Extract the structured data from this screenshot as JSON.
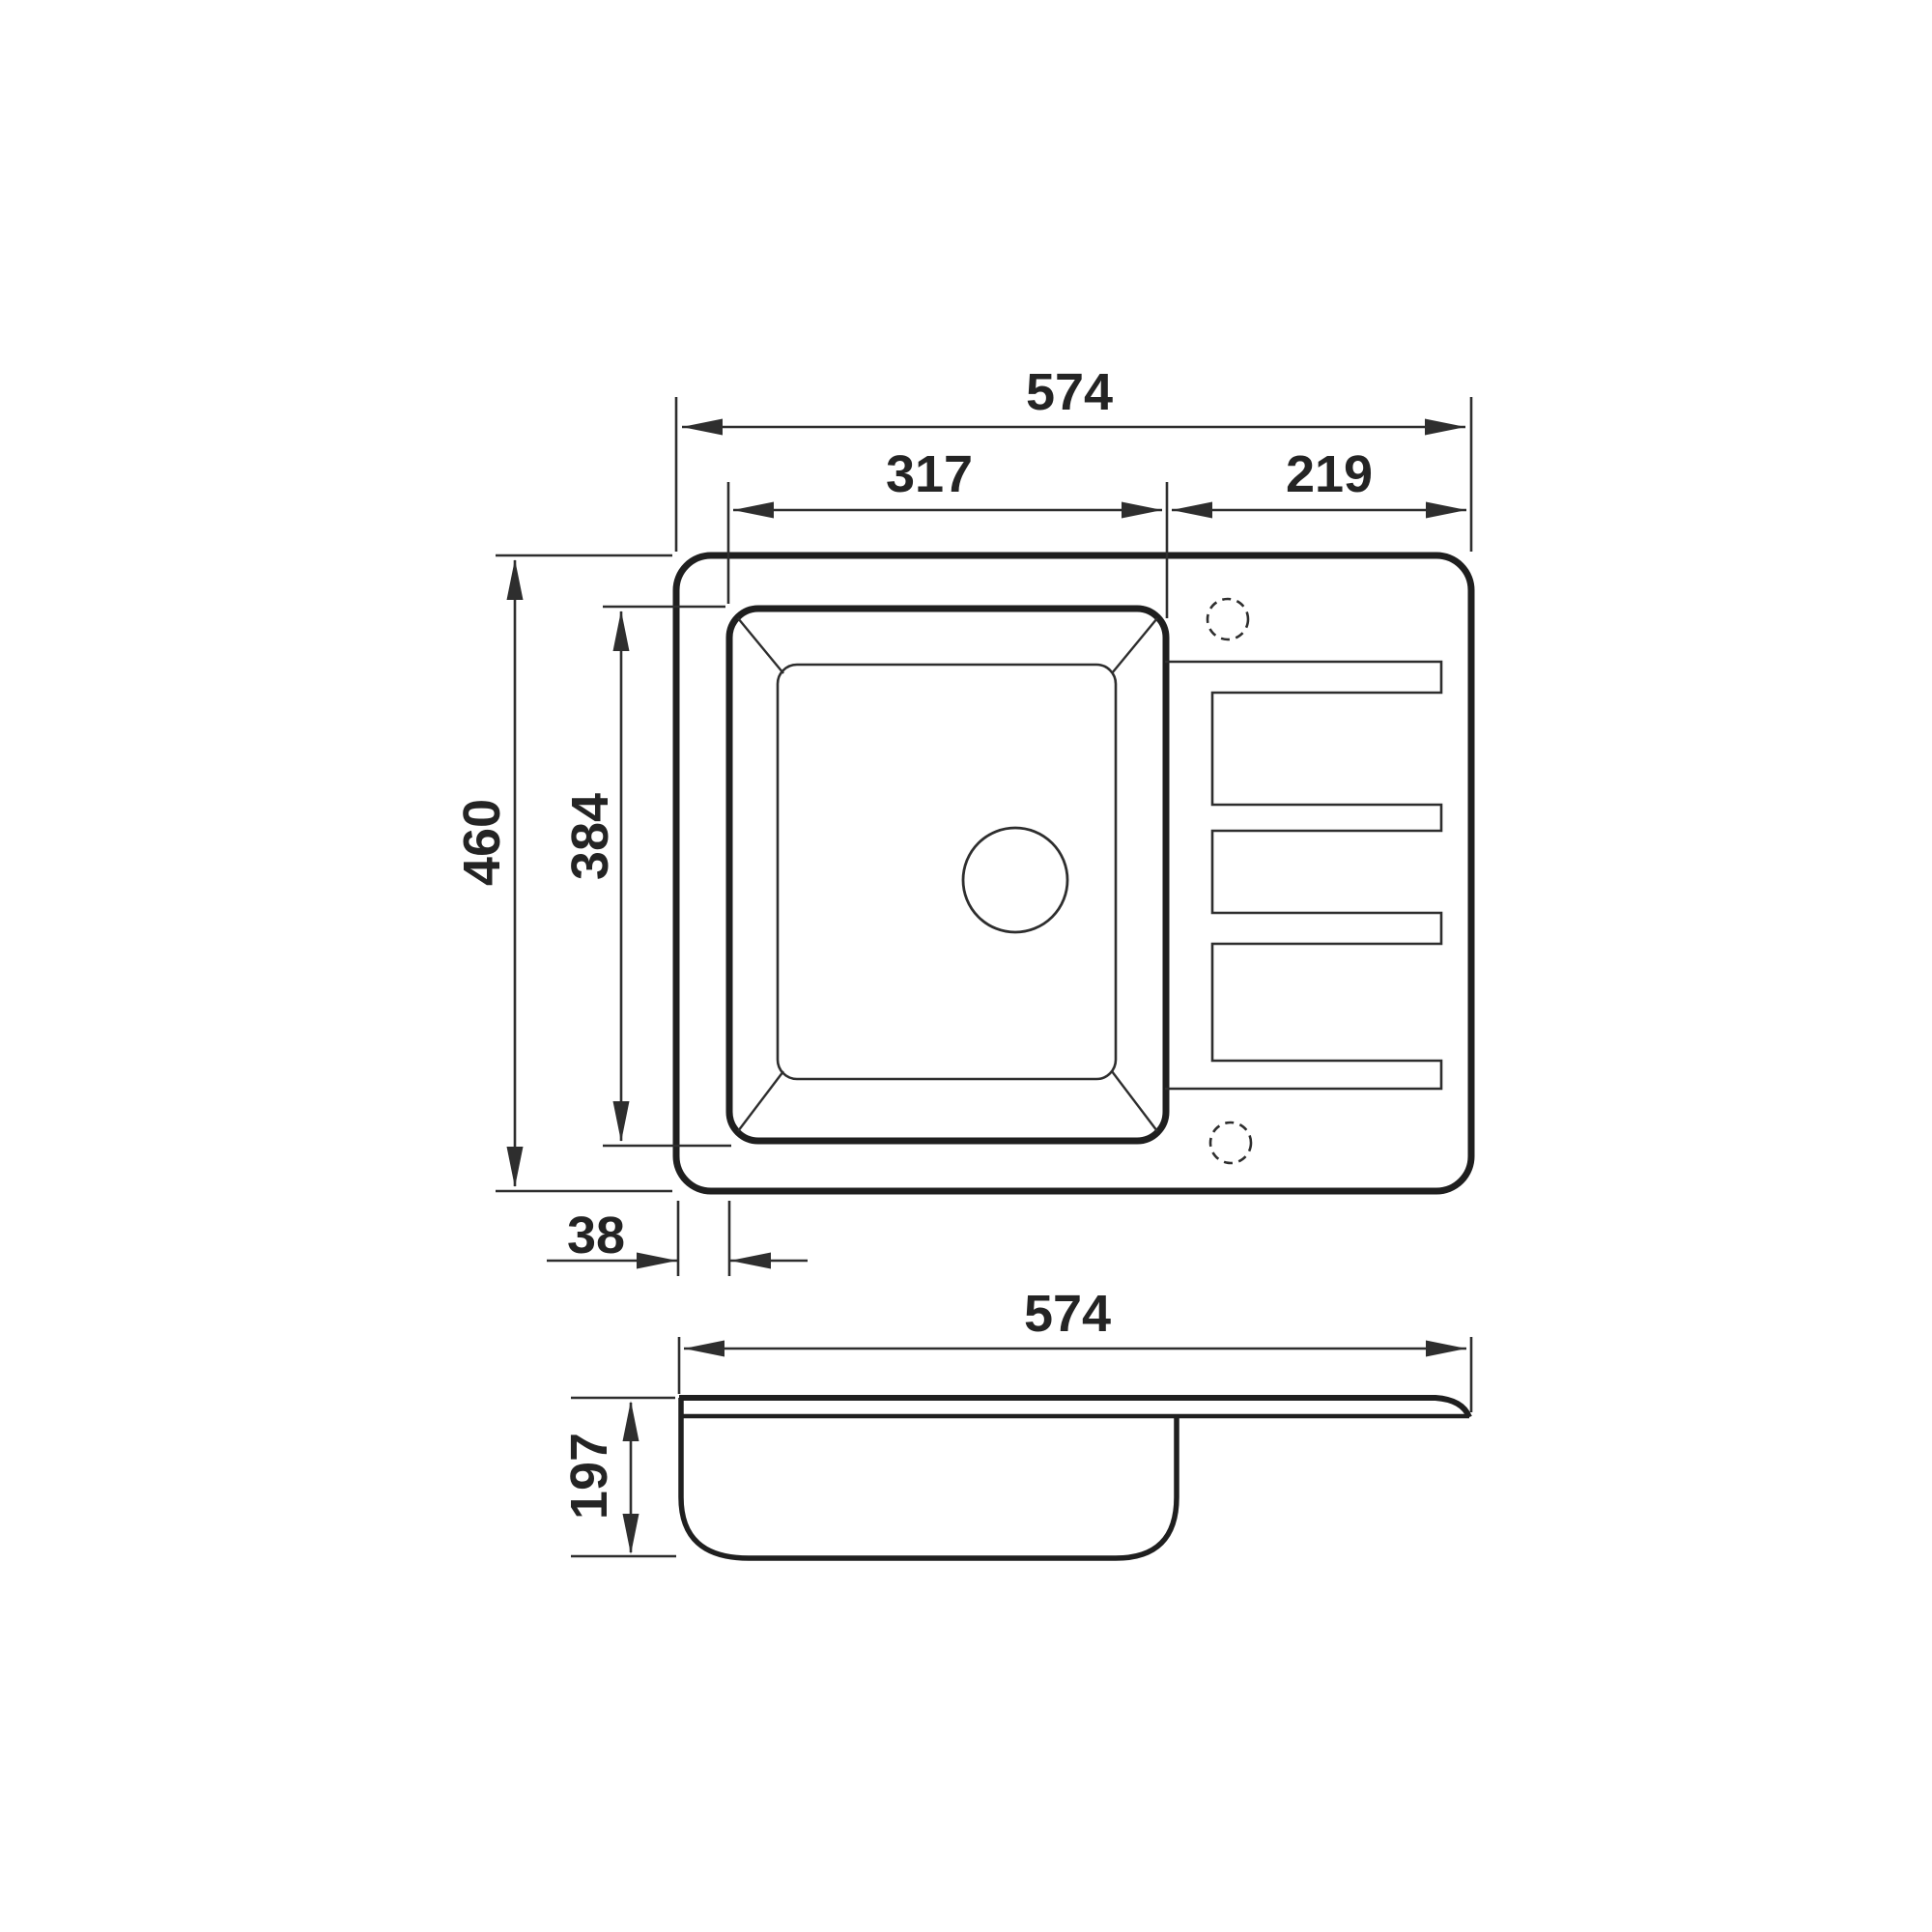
{
  "drawing": {
    "description": "Dimensioned technical line drawing of a kitchen sink with one bowl and a drainboard: top (plan) view and side (section) view",
    "line_color": "#232323",
    "background_color": "#ffffff",
    "top_view": {
      "overall_width": "574",
      "bowl_cutout_width": "317",
      "drainboard_width": "219",
      "overall_depth": "460",
      "bowl_cutout_depth": "384",
      "bowl_left_offset": "38"
    },
    "side_view": {
      "overall_width": "574",
      "bowl_depth": "197"
    }
  }
}
